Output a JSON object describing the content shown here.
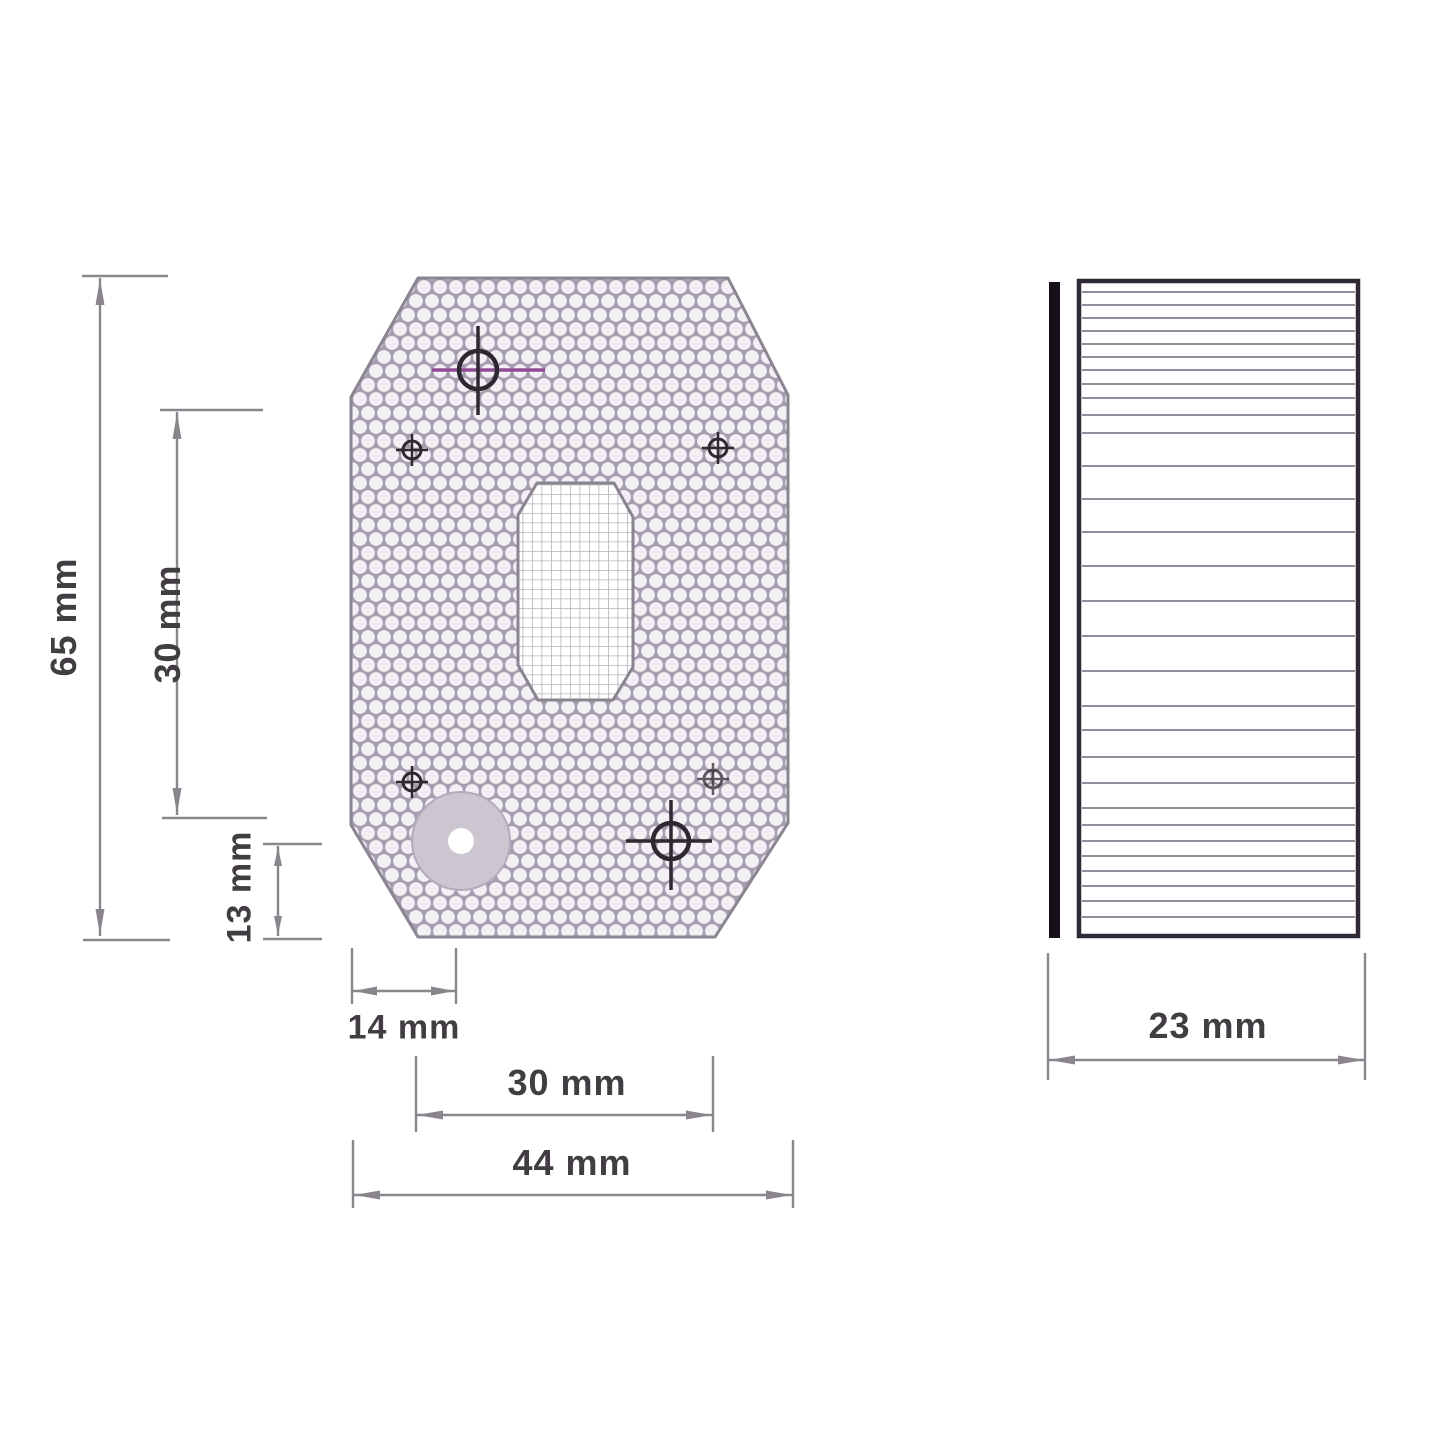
{
  "drawing": {
    "kind": "technical-drawing",
    "views": {
      "front": {
        "description": "front view of octagonal honeycomb reflector plate",
        "features": [
          "honeycomb-pattern",
          "two-large-crosshair-targets",
          "four-small-mount-marks",
          "central-oval-grid-cutout",
          "gray-disc-with-center-hole"
        ]
      },
      "side": {
        "description": "side profile with horizontal ribbing and mounting strip"
      }
    },
    "dimensions": {
      "overall_height": "65 mm",
      "hole_spacing_vertical": "30 mm",
      "disc_center_from_bottom": "13 mm",
      "disc_center_from_left": "14 mm",
      "hole_spacing_horizontal": "30 mm",
      "overall_width": "44 mm",
      "overall_depth": "23 mm"
    },
    "colors": {
      "line": "#8a858c",
      "text": "#423c43",
      "outline": "#8b8592",
      "pattern_line": "#a59db0",
      "pattern_fill": "#f2eff5",
      "grid_line": "#b6b1bc",
      "marker_dark": "#2e2830",
      "marker_accent": "#8d4f93",
      "disc_fill": "#cbc6cf",
      "disc_edge": "#b2abbe",
      "side_bar": "#17101a",
      "side_border": "#302834",
      "side_line": "#938b9a"
    }
  }
}
